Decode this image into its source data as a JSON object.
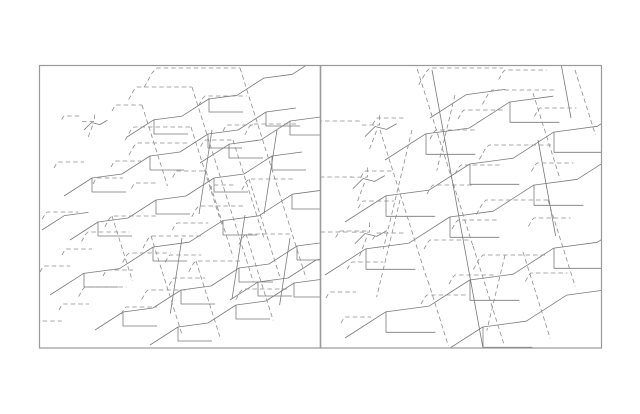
{
  "figure": {
    "width": 640,
    "height": 414,
    "background": "#ffffff",
    "border_color": "#9a9a9a",
    "border_width": 1.2,
    "divider_width": 1.6,
    "solid_color": "#7a7a7a",
    "dashed_color": "#8d8d8d",
    "line_width": 0.8,
    "dash_pattern": "4.5 3",
    "outer": {
      "x": 39.5,
      "y": 65.5,
      "w": 562,
      "h": 282.5
    },
    "divider_x": 320.5,
    "panels": [
      {
        "name": "left-panel",
        "x": 39.5,
        "y": 65.5,
        "w": 281,
        "h": 282.5
      },
      {
        "name": "right-panel",
        "x": 320.5,
        "y": 65.5,
        "w": 281.5,
        "h": 282.5
      }
    ]
  },
  "motifs": {
    "stream": [
      [
        0,
        0
      ],
      [
        28,
        -18
      ],
      [
        58,
        -22
      ],
      [
        86,
        -40
      ],
      [
        116,
        -44
      ],
      [
        144,
        -62
      ],
      [
        174,
        -66
      ],
      [
        202,
        -84
      ],
      [
        232,
        -88
      ]
    ],
    "stream_half": [
      [
        0,
        0
      ],
      [
        28,
        -18
      ],
      [
        58,
        -22
      ],
      [
        86,
        -40
      ],
      [
        116,
        -44
      ]
    ],
    "stream_short": [
      [
        0,
        0
      ],
      [
        28,
        -18
      ],
      [
        58,
        -22
      ]
    ],
    "trib": [
      [
        0,
        0
      ],
      [
        0,
        14
      ],
      [
        34,
        14
      ]
    ],
    "stub": [
      [
        -8,
        12
      ],
      [
        -3,
        3
      ],
      [
        0,
        0
      ],
      [
        52,
        0
      ]
    ],
    "diag": [
      [
        0,
        0
      ],
      [
        34,
        108
      ]
    ],
    "diagL": [
      [
        0,
        0
      ],
      [
        -26,
        108
      ]
    ],
    "trunkL": [
      [
        0,
        0
      ],
      [
        -13,
        84
      ]
    ],
    "trunkR": [
      [
        0,
        0
      ],
      [
        22,
        120
      ]
    ],
    "mini_a": [
      [
        0,
        9
      ],
      [
        12,
        9
      ],
      [
        12,
        1
      ]
    ],
    "mini_b": [
      [
        2,
        17
      ],
      [
        9,
        10
      ],
      [
        17,
        12
      ],
      [
        24,
        8
      ]
    ],
    "mini_c": [
      [
        10,
        13
      ],
      [
        5,
        26
      ]
    ]
  },
  "lines": [
    [
      "stream",
      64,
      196,
      1,
      0,
      0
    ],
    [
      "stream",
      127,
      137,
      0.95,
      0,
      0
    ],
    [
      "stream",
      70,
      240,
      1,
      0,
      0
    ],
    [
      "stream",
      50,
      295,
      1.2,
      0,
      0
    ],
    [
      "stream",
      95,
      330,
      1,
      0,
      0
    ],
    [
      "stream",
      150,
      345,
      1,
      0,
      0
    ],
    [
      "stream_half",
      200,
      163,
      1.05,
      0,
      0
    ],
    [
      "stream_half",
      230,
      300,
      1,
      0,
      0
    ],
    [
      "stream_short",
      42,
      230,
      0.8,
      0,
      0
    ],
    [
      "trib",
      92,
      178,
      1,
      0,
      0
    ],
    [
      "trib",
      150,
      156,
      1,
      0,
      0
    ],
    [
      "trib",
      208,
      134,
      1,
      0,
      0
    ],
    [
      "trib",
      266,
      112,
      1,
      0,
      0
    ],
    [
      "trib",
      154,
      120,
      1,
      0,
      0
    ],
    [
      "trib",
      209,
      98,
      1,
      0,
      0
    ],
    [
      "trib",
      98,
      222,
      1,
      0,
      0
    ],
    [
      "trib",
      156,
      200,
      1,
      0,
      0
    ],
    [
      "trib",
      214,
      178,
      1,
      0,
      0
    ],
    [
      "trib",
      272,
      156,
      1,
      0,
      0
    ],
    [
      "trib",
      84,
      273,
      1,
      0,
      0
    ],
    [
      "trib",
      153,
      247,
      1,
      0,
      0
    ],
    [
      "trib",
      223,
      221,
      1,
      0,
      0
    ],
    [
      "trib",
      292,
      195,
      1,
      0,
      0
    ],
    [
      "trib",
      123,
      312,
      1,
      0,
      0
    ],
    [
      "trib",
      181,
      290,
      1,
      0,
      0
    ],
    [
      "trib",
      239,
      268,
      1,
      0,
      0
    ],
    [
      "trib",
      297,
      246,
      1,
      0,
      0
    ],
    [
      "trib",
      178,
      327,
      1,
      0,
      0
    ],
    [
      "trib",
      236,
      305,
      1,
      0,
      0
    ],
    [
      "trib",
      294,
      283,
      1,
      0,
      0
    ],
    [
      "trib",
      229,
      144,
      1,
      0,
      0
    ],
    [
      "trib",
      290,
      121,
      1,
      0,
      0
    ],
    [
      "trib",
      258,
      282,
      1,
      0,
      0
    ],
    [
      "trunkL",
      212,
      130,
      1,
      0,
      0
    ],
    [
      "trunkL",
      277,
      130,
      1,
      0,
      0
    ],
    [
      "trunkL",
      245,
      215,
      1,
      0,
      0
    ],
    [
      "trunkL",
      182,
      238,
      0.9,
      0,
      0
    ],
    [
      "trunkL",
      290,
      238,
      0.8,
      0,
      0
    ],
    [
      "mini_a",
      82,
      112,
      1.05,
      1,
      0
    ],
    [
      "mini_b",
      82,
      112,
      1.05,
      0,
      0
    ],
    [
      "mini_c",
      82,
      112,
      1.05,
      1,
      0
    ],
    [
      "stub",
      64,
      116,
      0.3,
      1,
      0
    ],
    [
      "stub",
      157,
      68,
      1.6,
      1,
      0
    ],
    [
      "stub",
      137,
      87,
      1.05,
      1,
      0
    ],
    [
      "stub",
      116,
      105,
      0.5,
      1,
      0
    ],
    [
      "stub",
      134,
      127,
      1.1,
      1,
      0
    ],
    [
      "stub",
      137,
      143,
      1,
      1,
      0
    ],
    [
      "stub",
      115,
      161,
      0.5,
      1,
      0
    ],
    [
      "stub",
      58,
      162,
      0.5,
      1,
      0
    ],
    [
      "stub",
      97,
      178,
      0.5,
      1,
      0
    ],
    [
      "stub",
      135,
      183,
      0.45,
      1,
      0
    ],
    [
      "stub",
      205,
      140,
      0.55,
      1,
      0
    ],
    [
      "stub",
      227,
      125,
      0.5,
      1,
      0
    ],
    [
      "stub",
      177,
      171,
      0.55,
      1,
      0
    ],
    [
      "stub",
      213,
      185,
      0.45,
      1,
      0
    ],
    [
      "stub",
      205,
      96,
      0.8,
      1,
      0
    ],
    [
      "stub",
      47,
      212,
      0.6,
      1,
      0
    ],
    [
      "stub",
      112,
      216,
      0.9,
      1,
      0
    ],
    [
      "stub",
      151,
      236,
      1,
      1,
      0
    ],
    [
      "stub",
      129,
      253,
      0.8,
      1,
      0
    ],
    [
      "stub",
      88,
      232,
      0.8,
      1,
      0
    ],
    [
      "stub",
      66,
      249,
      0.5,
      1,
      0
    ],
    [
      "stub",
      107,
      270,
      0.5,
      1,
      0
    ],
    [
      "stub",
      85,
      287,
      0.8,
      1,
      0
    ],
    [
      "stub",
      63,
      304,
      0.5,
      1,
      0
    ],
    [
      "stub",
      44,
      266,
      0.5,
      1,
      0
    ],
    [
      "stub",
      41,
      321,
      0.4,
      1,
      0
    ],
    [
      "stub",
      148,
      290,
      0.8,
      1,
      0
    ],
    [
      "stub",
      126,
      307,
      0.6,
      1,
      0
    ],
    [
      "stub",
      170,
      255,
      0.6,
      1,
      0
    ],
    [
      "stub",
      196,
      261,
      0.9,
      1,
      0
    ],
    [
      "stub",
      174,
      278,
      0.6,
      1,
      0
    ],
    [
      "stub",
      199,
      206,
      0.9,
      1,
      0
    ],
    [
      "stub",
      177,
      223,
      0.6,
      1,
      0
    ],
    [
      "stub",
      249,
      179,
      0.9,
      1,
      0
    ],
    [
      "stub",
      246,
      234,
      0.9,
      1,
      0
    ],
    [
      "stub",
      243,
      289,
      0.9,
      1,
      0
    ],
    [
      "stub",
      252,
      124,
      0.9,
      1,
      0
    ],
    [
      "diag",
      240,
      68,
      1.15,
      1,
      0
    ],
    [
      "diag",
      192,
      87,
      1,
      1,
      0
    ],
    [
      "diag",
      226,
      195,
      0.8,
      1,
      0
    ],
    [
      "diag",
      142,
      105,
      0.75,
      1,
      0
    ],
    [
      "diag",
      191,
      127,
      0.9,
      1,
      0
    ],
    [
      "diag",
      233,
      140,
      0.9,
      1,
      0
    ],
    [
      "diag",
      206,
      171,
      0.8,
      1,
      0
    ],
    [
      "diag",
      151,
      236,
      0.9,
      1,
      0
    ],
    [
      "diag",
      196,
      261,
      0.7,
      1,
      0
    ],
    [
      "diag",
      249,
      179,
      0.9,
      1,
      0
    ],
    [
      "diag",
      246,
      234,
      0.8,
      1,
      0
    ],
    [
      "diag",
      112,
      216,
      0.6,
      1,
      0
    ],
    [
      "diag",
      279,
      192,
      0.8,
      1,
      0
    ],
    [
      "stream",
      345,
      222,
      1.45,
      0,
      1
    ],
    [
      "stream",
      325,
      275,
      1.45,
      0,
      1
    ],
    [
      "stream",
      345,
      338,
      1.45,
      0,
      1
    ],
    [
      "stream",
      358,
      385,
      1.45,
      0,
      1
    ],
    [
      "stream_half",
      385,
      160,
      1.45,
      0,
      1
    ],
    [
      "stream_short",
      430,
      118,
      1.3,
      0,
      1
    ],
    [
      "trib",
      386,
      196,
      1.45,
      0,
      1
    ],
    [
      "trib",
      470,
      164,
      1.45,
      0,
      1
    ],
    [
      "trib",
      554,
      132,
      1.45,
      0,
      1
    ],
    [
      "trib",
      366,
      249,
      1.45,
      0,
      1
    ],
    [
      "trib",
      450,
      217,
      1.45,
      0,
      1
    ],
    [
      "trib",
      534,
      185,
      1.45,
      0,
      1
    ],
    [
      "trib",
      386,
      312,
      1.45,
      0,
      1
    ],
    [
      "trib",
      470,
      280,
      1.45,
      0,
      1
    ],
    [
      "trib",
      554,
      248,
      1.45,
      0,
      1
    ],
    [
      "trib",
      399,
      359,
      1.45,
      0,
      1
    ],
    [
      "trib",
      483,
      327,
      1.45,
      0,
      1
    ],
    [
      "trib",
      426,
      134,
      1.45,
      0,
      1
    ],
    [
      "trib",
      510,
      102,
      1.45,
      0,
      1
    ],
    [
      "trunkR",
      432,
      70,
      1.5,
      0,
      1
    ],
    [
      "trunkR",
      465,
      250,
      0.85,
      0,
      1
    ],
    [
      "trunkR",
      538,
      140,
      0.8,
      0,
      1
    ],
    [
      "trunkR",
      560,
      58,
      0.5,
      0,
      1
    ],
    [
      "mini_a",
      362,
      112,
      1.45,
      1,
      1
    ],
    [
      "mini_b",
      362,
      112,
      1.45,
      0,
      1
    ],
    [
      "mini_c",
      362,
      112,
      1.45,
      1,
      1
    ],
    [
      "mini_a",
      350,
      164,
      1.45,
      1,
      1
    ],
    [
      "mini_b",
      350,
      164,
      1.45,
      0,
      1
    ],
    [
      "mini_c",
      350,
      164,
      1.45,
      1,
      1
    ],
    [
      "mini_a",
      352,
      219,
      1.45,
      1,
      1
    ],
    [
      "mini_b",
      352,
      219,
      1.45,
      0,
      1
    ],
    [
      "mini_c",
      352,
      219,
      1.45,
      1,
      1
    ],
    [
      "stub",
      492,
      90,
      1.2,
      1,
      1
    ],
    [
      "stub",
      464,
      110,
      0.75,
      1,
      1
    ],
    [
      "stub",
      436,
      130,
      0.75,
      1,
      1
    ],
    [
      "stub",
      489,
      145,
      1.2,
      1,
      1
    ],
    [
      "stub",
      461,
      165,
      0.75,
      1,
      1
    ],
    [
      "stub",
      433,
      185,
      0.75,
      1,
      1
    ],
    [
      "stub",
      486,
      200,
      1.2,
      1,
      1
    ],
    [
      "stub",
      458,
      220,
      0.75,
      1,
      1
    ],
    [
      "stub",
      430,
      240,
      0.75,
      1,
      1
    ],
    [
      "stub",
      483,
      255,
      1.2,
      1,
      1
    ],
    [
      "stub",
      455,
      275,
      0.75,
      1,
      1
    ],
    [
      "stub",
      427,
      295,
      0.75,
      1,
      1
    ],
    [
      "stub",
      540,
      108,
      0.7,
      1,
      1
    ],
    [
      "stub",
      537,
      163,
      0.7,
      1,
      1
    ],
    [
      "stub",
      534,
      218,
      0.7,
      1,
      1
    ],
    [
      "stub",
      531,
      273,
      0.7,
      1,
      1
    ],
    [
      "stub",
      430,
      68,
      1.4,
      1,
      1
    ],
    [
      "stub",
      505,
      70,
      0.8,
      1,
      1
    ],
    [
      "stub",
      363,
      201,
      0.6,
      1,
      1
    ],
    [
      "stub",
      340,
      231,
      0.55,
      1,
      1
    ],
    [
      "stub",
      352,
      262,
      0.6,
      1,
      1
    ],
    [
      "stub",
      330,
      292,
      0.5,
      1,
      1
    ],
    [
      "stub",
      345,
      317,
      0.5,
      1,
      1
    ],
    [
      "stub",
      321,
      121,
      0.75,
      1,
      1
    ],
    [
      "stub",
      321,
      177,
      0.6,
      1,
      1
    ],
    [
      "stub",
      321,
      232,
      0.55,
      1,
      1
    ],
    [
      "stub",
      377,
      118,
      0.55,
      1,
      1
    ],
    [
      "stub",
      365,
      171,
      0.55,
      1,
      1
    ],
    [
      "stub",
      377,
      233,
      0.55,
      1,
      1
    ],
    [
      "diag",
      415,
      62,
      1.7,
      1,
      1
    ],
    [
      "diag",
      473,
      246,
      0.9,
      1,
      1
    ],
    [
      "diag",
      533,
      93,
      0.8,
      1,
      1
    ],
    [
      "diag",
      548,
      200,
      0.8,
      1,
      1
    ],
    [
      "diag",
      380,
      130,
      1.4,
      1,
      1
    ],
    [
      "diag",
      428,
      281,
      0.6,
      1,
      1
    ],
    [
      "diag",
      523,
      252,
      0.8,
      1,
      1
    ],
    [
      "diag",
      575,
      70,
      0.6,
      1,
      1
    ],
    [
      "diagL",
      412,
      130,
      1.1,
      1,
      1
    ],
    [
      "diagL",
      400,
      200,
      0.9,
      1,
      1
    ],
    [
      "diagL",
      455,
      95,
      0.7,
      1,
      1
    ],
    [
      "diagL",
      505,
      255,
      0.7,
      1,
      1
    ]
  ]
}
